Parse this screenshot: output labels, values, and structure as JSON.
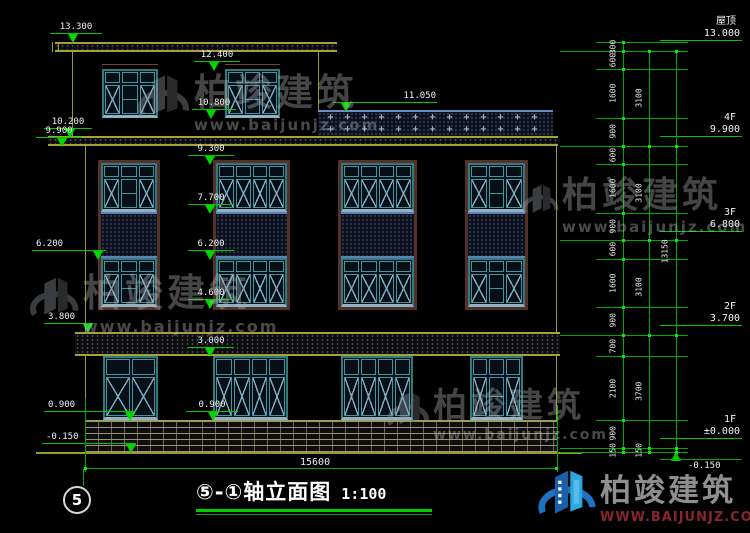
{
  "title": {
    "text": "⑤-①轴立面图",
    "scale": "1:100"
  },
  "axis_bubble": "5",
  "watermark": {
    "brand": "柏竣建筑",
    "url": "www.baijunjz.com",
    "url_caps": "WWW.BAIJUNJZ.COM"
  },
  "elev_markers": {
    "m13300": "13.300",
    "m12400": "12.400",
    "m11050": "11.050",
    "m10800": "10.800",
    "m10200": "10.200",
    "m9900l": "9.900",
    "m9300": "9.300",
    "m7700": "7.700",
    "m6200a": "6.200",
    "m6200b": "6.200",
    "m4600": "4.600",
    "m3800": "3.800",
    "m3000": "3.000",
    "m0900a": "0.900",
    "m0900b": "0.900",
    "mneg150": "-0.150",
    "mneg150r": "-0.150"
  },
  "floors": [
    {
      "name": "屋顶",
      "elev": "13.000"
    },
    {
      "name": "4F",
      "elev": "9.900"
    },
    {
      "name": "3F",
      "elev": "6.800"
    },
    {
      "name": "2F",
      "elev": "3.700"
    },
    {
      "name": "1F",
      "elev": "±0.000"
    }
  ],
  "dims": {
    "inner": [
      "300",
      "600",
      "1600",
      "900",
      "600",
      "1600",
      "900",
      "600",
      "1600",
      "900",
      "700",
      "2100",
      "900",
      "150"
    ],
    "floor": [
      "3100",
      "3100",
      "3100",
      "3700",
      "150"
    ],
    "total_height": "13150",
    "total_width": "15600"
  },
  "levels_mm": [
    13300,
    13000,
    12400,
    10800,
    9900,
    9300,
    7700,
    6800,
    6200,
    4600,
    3700,
    3000,
    900,
    0,
    -150
  ],
  "floor_levels_mm": [
    13000,
    9900,
    6800,
    3700,
    0,
    -150
  ],
  "railing": {
    "symbol": "+",
    "rows": 2,
    "count": 13
  },
  "building_summary": {
    "middle_window_strips": 4,
    "first_floor_windows": 4,
    "fourth_floor_windows": 2
  },
  "colors": {
    "dim_line": "#00c800",
    "wall_line": "#9a9a2e",
    "window_frame": "#2d7d7d",
    "brand_blue": "#2aa7df",
    "brand_navy": "#1a5fa8",
    "url_red": "#8a2430"
  }
}
